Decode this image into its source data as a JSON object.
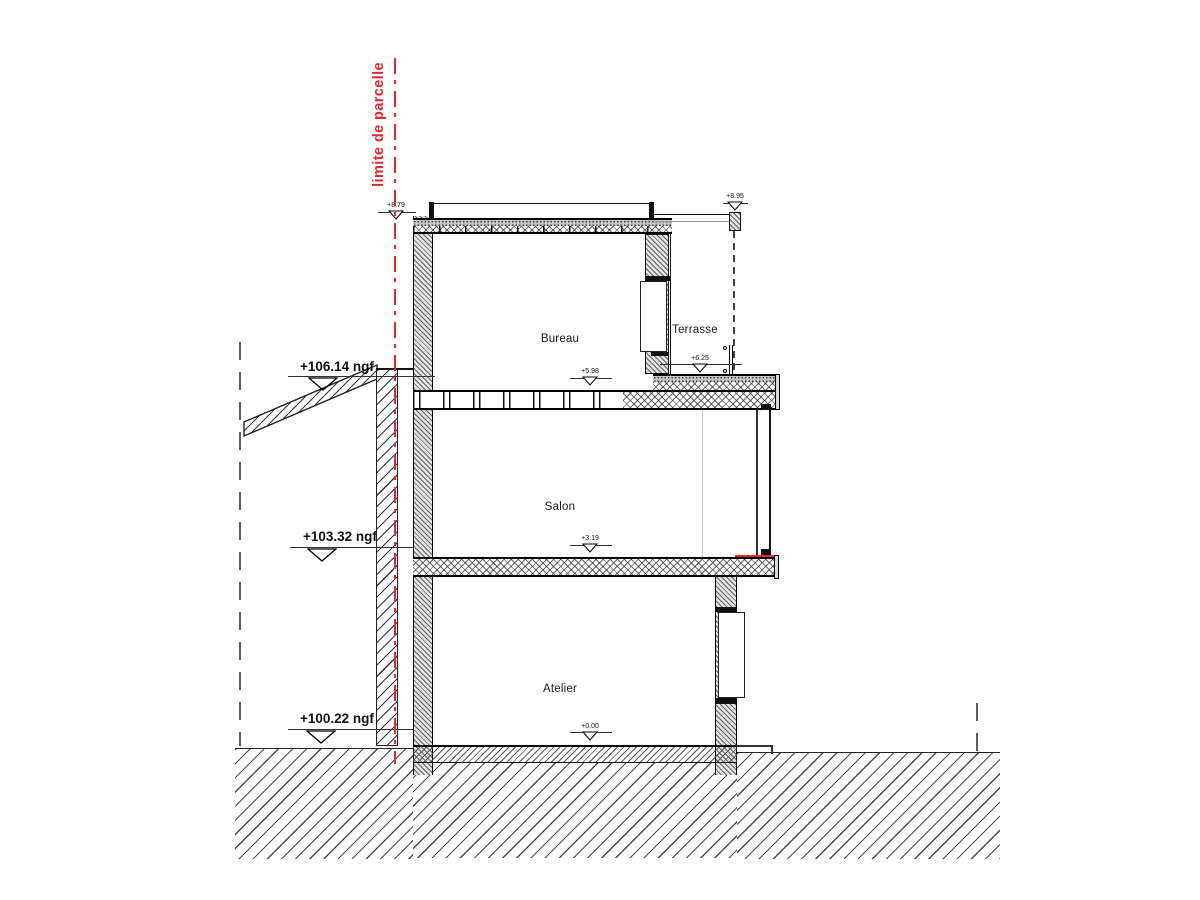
{
  "drawing": {
    "title": "coupe - section drawing",
    "parcel_label": "limite de parcelle",
    "accent_red": "#e8262d",
    "ink_color": "#111111",
    "rooms": {
      "bureau": "Bureau",
      "terrasse": "Terrasse",
      "salon": "Salon",
      "atelier": "Atelier"
    },
    "levels": {
      "roof": "+8.79",
      "screen_top": "+8.95",
      "bureau_floor": "+5.98",
      "terrasse_floor": "+6.25",
      "salon_floor": "+3.19",
      "atelier_floor": "+0.00"
    },
    "ngf": {
      "neighbor_roof": "+106.14 ngf",
      "mid": "+103.32 ngf",
      "ground": "+100.22 ngf"
    }
  }
}
